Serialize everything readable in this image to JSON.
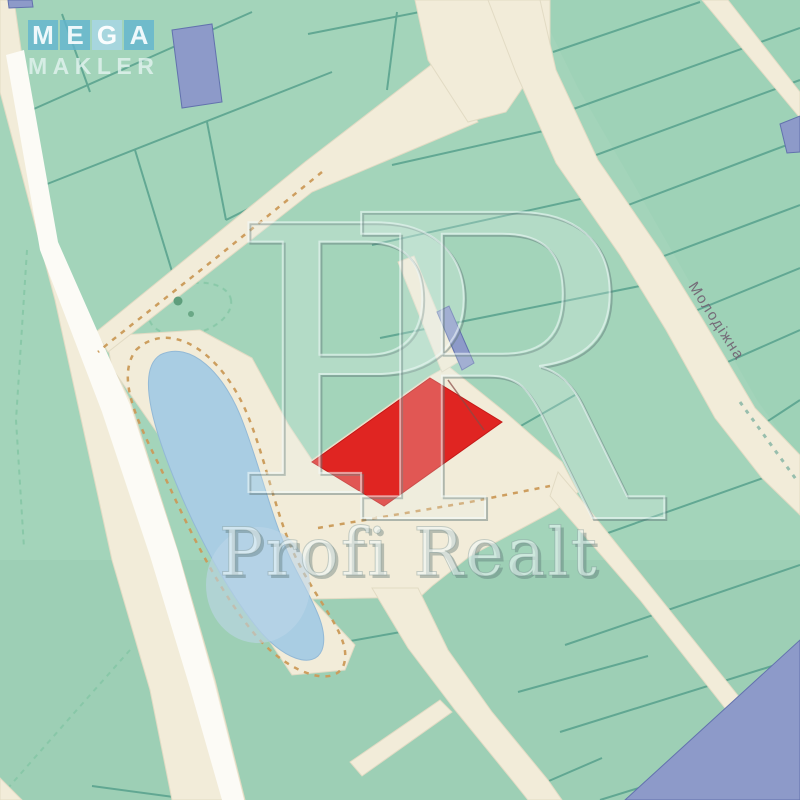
{
  "map": {
    "street_label": "Молодіжна",
    "highlight_parcel": "red-outlined listing parcel",
    "colors": {
      "land": "#a3d4ba",
      "road": "#f2ecd9",
      "road_white": "#fcfbf6",
      "water": "#a9cde3",
      "parcel_line": "#57a18d",
      "trail_dash": "#cb9a58",
      "boundary_dash_green": "#86c7a6",
      "highlight_red": "#e02522",
      "building_blue": "#8d9ac9"
    }
  },
  "watermarks": {
    "logo": {
      "letters": [
        "M",
        "E",
        "G",
        "A"
      ],
      "word2": "MAKLER"
    },
    "monogram": {
      "p": "P",
      "r": "R"
    },
    "brand_text": "Profi Realt"
  }
}
